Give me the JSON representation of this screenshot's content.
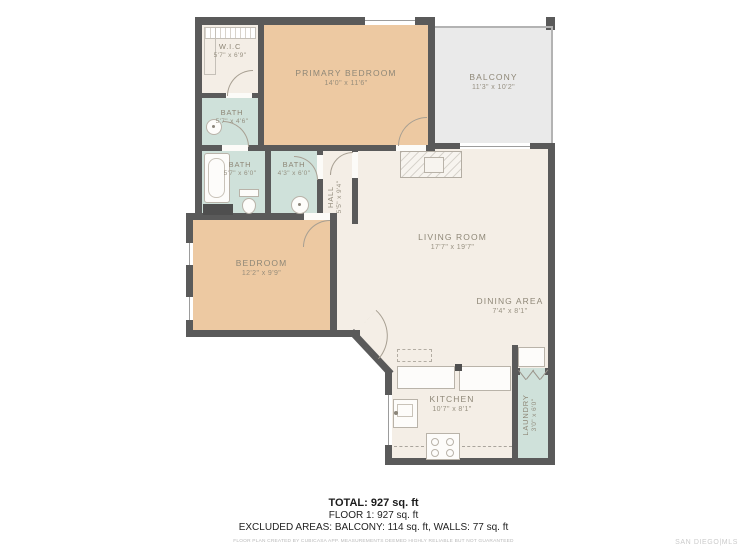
{
  "rooms": {
    "wic": {
      "label": "W.I.C",
      "dims": "5'7\" x 6'9\""
    },
    "primary_bedroom": {
      "label": "PRIMARY BEDROOM",
      "dims": "14'0\" x 11'6\""
    },
    "balcony": {
      "label": "BALCONY",
      "dims": "11'3\" x 10'2\""
    },
    "bath_primary": {
      "label": "BATH",
      "dims": "5'7\" x 4'6\""
    },
    "bath_tub": {
      "label": "BATH",
      "dims": "5'7\" x 6'0\""
    },
    "bath_hall": {
      "label": "BATH",
      "dims": "4'3\" x 6'0\""
    },
    "hall": {
      "label": "HALL",
      "dims": "5'5\" x 9'4\""
    },
    "bedroom": {
      "label": "BEDROOM",
      "dims": "12'2\" x 9'9\""
    },
    "living_room": {
      "label": "LIVING ROOM",
      "dims": "17'7\" x 19'7\""
    },
    "dining_area": {
      "label": "DINING AREA",
      "dims": "7'4\" x 8'1\""
    },
    "kitchen": {
      "label": "KITCHEN",
      "dims": "10'7\" x 8'1\""
    },
    "laundry": {
      "label": "LAUNDRY",
      "dims": "3'0\" x 6'0\""
    }
  },
  "summary": {
    "total": "TOTAL: 927 sq. ft",
    "floor": "FLOOR 1: 927 sq. ft",
    "excluded": "EXCLUDED AREAS: BALCONY: 114 sq. ft, WALLS: 77 sq. ft",
    "disclaimer": "FLOOR PLAN CREATED BY CUBICASA APP. MEASUREMENTS DEEMED HIGHLY RELIABLE BUT NOT GUARANTEED",
    "watermark": "SAN DIEGO|MLS"
  },
  "colors": {
    "wall": "#5a5a5a",
    "bedroom_fill": "#edc9a2",
    "bath_fill": "#cfe1da",
    "living_fill": "#f4eee6",
    "balcony_fill": "#eaeaea",
    "label_text": "#8e8777"
  }
}
